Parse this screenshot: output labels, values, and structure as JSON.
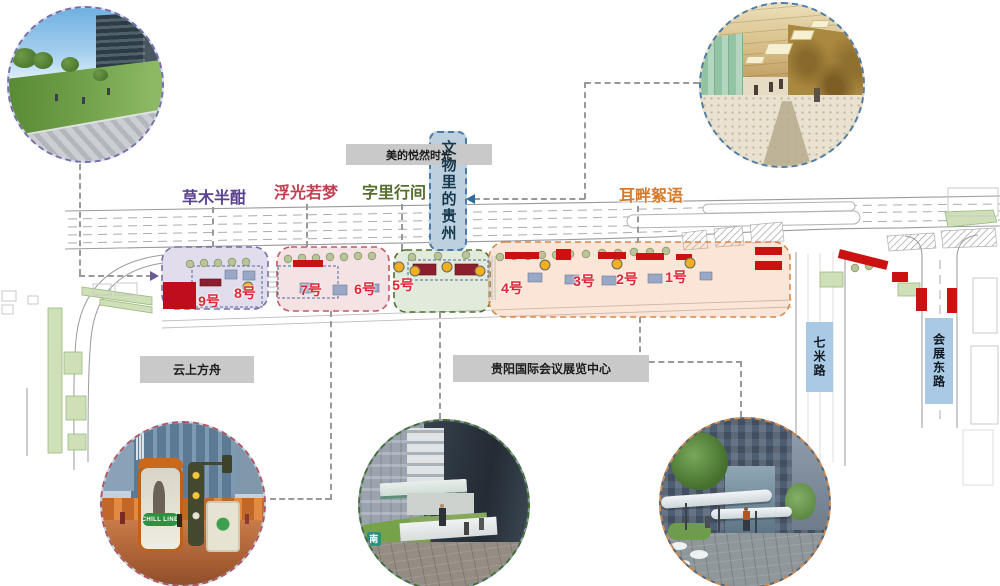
{
  "palette": {
    "stall_number_red": "#E02537",
    "highlight_red": "#CC1111",
    "marker_yellow": "#F2B01E",
    "road_label_bg": "#A9C9E4",
    "callout_box_bg": "#C9C9C9",
    "banner_bg": "#BCD0E0",
    "banner_text": "#16384F"
  },
  "zones": [
    {
      "label": "草木半酣",
      "accent": "#5C4391"
    },
    {
      "label": "浮光若梦",
      "accent": "#C24052"
    },
    {
      "label": "字里行间",
      "accent": "#56702F"
    },
    {
      "label": "耳畔絮语",
      "accent": "#D7792A"
    }
  ],
  "stalls": [
    "9号",
    "8号",
    "7号",
    "6号",
    "5号",
    "4号",
    "3号",
    "2号",
    "1号"
  ],
  "callouts": {
    "meide": "美的悦然时光",
    "yunshang": "云上方舟",
    "convention": "贵阳国际会议展览中心"
  },
  "banner": {
    "label": "文物里的贵州"
  },
  "roads": {
    "qimilu": "七米路",
    "huizhandonglu": "会展东路"
  },
  "photos": {
    "park": {
      "desc": "lawn park rendering"
    },
    "corridor": {
      "desc": "culture corridor interior rendering"
    },
    "plaza": {
      "desc": "plaza installation rendering",
      "sign": "CHILL LINE"
    },
    "street_mid": {
      "desc": "street canopy rendering",
      "logo": "南"
    },
    "street_right": {
      "desc": "storefront street rendering"
    }
  }
}
